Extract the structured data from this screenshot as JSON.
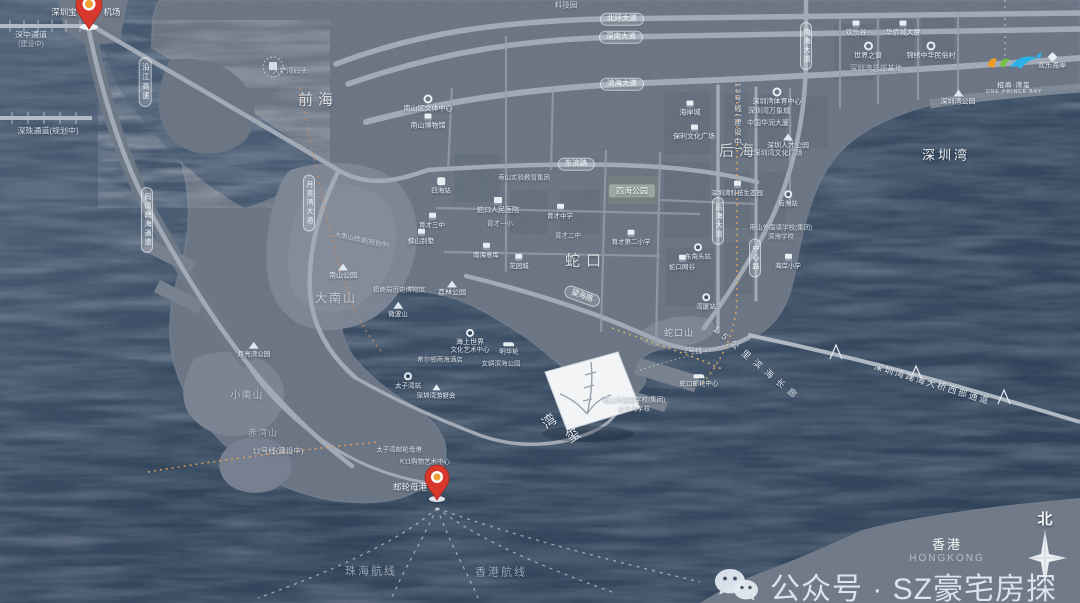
{
  "watermark": {
    "text": "公众号 · SZ豪宅房探"
  },
  "compass": {
    "north": "北"
  },
  "corner": {
    "hk": "香港",
    "hk_en": "HONGKONG"
  },
  "logo": {
    "line1": "招商·湾玺",
    "line2": "ONE PRINCE BAY"
  },
  "pins": [
    {
      "label_left": "深圳宝",
      "label_right": "机场"
    },
    {
      "label": "邮轮母港"
    }
  ],
  "colors": {
    "ocean": "#3a4d64",
    "land": "#6b7584",
    "hill": "#7e8795",
    "road": "#a0a8b4",
    "pin_red": "#d8382c",
    "metro_orange": "#dfa35b",
    "metro_yellow": "#d8c06a",
    "logo_orange": "#f59a23",
    "logo_green": "#7ac143",
    "logo_blue": "#2bb3e8"
  },
  "labels": [
    {
      "t": "前海",
      "k": "area",
      "x": 318,
      "y": 100,
      "fs": 15,
      "ls": 5,
      "o": 0.75
    },
    {
      "t": "后海",
      "k": "area",
      "x": 739,
      "y": 151,
      "fs": 15,
      "ls": 5,
      "o": 0.7
    },
    {
      "t": "蛇口",
      "k": "area",
      "x": 586,
      "y": 261,
      "fs": 15,
      "ls": 6,
      "o": 0.75
    },
    {
      "t": "深圳湾",
      "k": "area",
      "x": 946,
      "y": 156,
      "fs": 13,
      "ls": 3,
      "o": 0.9
    },
    {
      "t": "大南山",
      "k": "area",
      "x": 336,
      "y": 299,
      "fs": 12,
      "ls": 2,
      "o": 0.55
    },
    {
      "t": "小南山",
      "k": "area",
      "x": 247,
      "y": 396,
      "fs": 10,
      "ls": 1,
      "o": 0.5
    },
    {
      "t": "赤湾山",
      "k": "area",
      "x": 263,
      "y": 433,
      "fs": 9,
      "ls": 1,
      "o": 0.45
    },
    {
      "t": "蛇口山",
      "k": "area",
      "x": 679,
      "y": 333,
      "fs": 9,
      "ls": 1,
      "o": 0.65
    },
    {
      "t": "深中通道",
      "k": "text",
      "x": 31,
      "y": 35,
      "fs": 8,
      "o": 0.85
    },
    {
      "t": "(建设中)",
      "k": "text",
      "x": 31,
      "y": 45,
      "fs": 7,
      "o": 0.7
    },
    {
      "t": "深珠通道(规划中)",
      "k": "text",
      "x": 48,
      "y": 131,
      "fs": 8,
      "o": 0.85
    },
    {
      "t": "大铲湾码头",
      "k": "text",
      "x": 290,
      "y": 72,
      "fs": 7,
      "o": 0.75
    },
    {
      "t": "沿江高速",
      "k": "vpill",
      "x": 145,
      "y": 82,
      "fs": 7.5
    },
    {
      "t": "妈湾跨海通道",
      "k": "vpill",
      "x": 147,
      "y": 220,
      "fs": 7
    },
    {
      "t": "月亮湾大道",
      "k": "vpill",
      "x": 309,
      "y": 203,
      "fs": 7
    },
    {
      "t": "北环大道",
      "k": "pill",
      "x": 622,
      "y": 19,
      "fs": 7.5
    },
    {
      "t": "深南大道",
      "k": "pill",
      "x": 621,
      "y": 37,
      "fs": 7.5
    },
    {
      "t": "滨海大道",
      "k": "pill",
      "x": 622,
      "y": 84,
      "fs": 7.5
    },
    {
      "t": "东滨路",
      "k": "pill",
      "x": 576,
      "y": 164,
      "fs": 7.5
    },
    {
      "t": "望海路",
      "k": "pill",
      "x": 582,
      "y": 296,
      "fs": 7.5,
      "rot": 20
    },
    {
      "t": "南海大道",
      "k": "vpill",
      "x": 806,
      "y": 46,
      "fs": 7
    },
    {
      "t": "后海大道",
      "k": "vpill",
      "x": 718,
      "y": 221,
      "fs": 7
    },
    {
      "t": "中心路",
      "k": "vpill",
      "x": 755,
      "y": 258,
      "fs": 7
    },
    {
      "t": "13号线(建设中)",
      "k": "vtext",
      "x": 737,
      "y": 117,
      "fs": 7.5,
      "o": 0.9
    },
    {
      "t": "12号线(建设中)",
      "k": "text",
      "x": 278,
      "y": 452,
      "fs": 7.5,
      "o": 0.85
    },
    {
      "t": "2号线",
      "k": "text",
      "x": 693,
      "y": 352,
      "fs": 7,
      "o": 0.8
    },
    {
      "t": "深圳湾跨海大桥西部通道",
      "k": "text",
      "x": 932,
      "y": 384,
      "fs": 9,
      "rot": 17,
      "ls": 2,
      "o": 0.95,
      "n": "bridge-label"
    },
    {
      "t": "15公里滨海长廊",
      "k": "text",
      "x": 757,
      "y": 364,
      "fs": 9,
      "rot": 40,
      "ls": 6,
      "o": 0.9,
      "n": "promenade-label"
    },
    {
      "t": "珠海航线",
      "k": "route",
      "x": 371,
      "y": 572,
      "fs": 11,
      "ls": 2,
      "o": 0.65
    },
    {
      "t": "香港航线",
      "k": "route",
      "x": 501,
      "y": 573,
      "fs": 11,
      "ls": 2,
      "o": 0.65
    },
    {
      "t": "四海公园",
      "k": "park",
      "x": 632,
      "y": 191,
      "fs": 8
    },
    {
      "t": "科技园",
      "k": "text",
      "x": 566,
      "y": 6,
      "fs": 7.5,
      "o": 0.8
    },
    {
      "t": "欢乐谷",
      "k": "poi",
      "icon": "b",
      "x": 856,
      "y": 29,
      "fs": 7
    },
    {
      "t": "华侨城大厦",
      "k": "poi",
      "icon": "b",
      "x": 903,
      "y": 29,
      "fs": 7
    },
    {
      "t": "世界之窗",
      "k": "poi",
      "icon": "o",
      "x": 868,
      "y": 51,
      "fs": 7
    },
    {
      "t": "锦绣中华民俗村",
      "k": "poi",
      "icon": "o",
      "x": 931,
      "y": 51,
      "fs": 7
    },
    {
      "t": "深圳湾总部基地",
      "k": "text",
      "x": 876,
      "y": 69,
      "fs": 7.5,
      "o": 0.7
    },
    {
      "t": "深圳湾公园",
      "k": "poi",
      "icon": "m",
      "x": 958,
      "y": 98,
      "fs": 7
    },
    {
      "t": "欢乐海岸",
      "k": "poi",
      "icon": "d",
      "x": 1052,
      "y": 62,
      "fs": 7
    },
    {
      "t": "深圳湾体育中心",
      "k": "poi",
      "icon": "o",
      "x": 777,
      "y": 97,
      "fs": 7
    },
    {
      "t": "深圳湾万象城",
      "k": "text",
      "x": 769,
      "y": 112,
      "fs": 7,
      "o": 0.9
    },
    {
      "t": "中国华润大厦",
      "k": "text",
      "x": 768,
      "y": 124,
      "fs": 7,
      "o": 0.9
    },
    {
      "t": "深圳人才公园",
      "k": "poi",
      "icon": "m",
      "x": 788,
      "y": 142,
      "fs": 7
    },
    {
      "t": "深圳湾文化广场",
      "k": "text",
      "x": 778,
      "y": 154,
      "fs": 7,
      "o": 0.9
    },
    {
      "t": "海岸城",
      "k": "poi",
      "icon": "b",
      "x": 690,
      "y": 109,
      "fs": 7
    },
    {
      "t": "保利文化广场",
      "k": "poi",
      "icon": "b",
      "x": 694,
      "y": 133,
      "fs": 7
    },
    {
      "t": "深圳湾科技生态园",
      "k": "poi",
      "icon": "b",
      "x": 737,
      "y": 189,
      "fs": 6.5
    },
    {
      "t": "后海站",
      "k": "poi",
      "icon": "st",
      "x": 788,
      "y": 199,
      "fs": 6.5
    },
    {
      "t": "南山外国语学校(集团)",
      "k": "text",
      "x": 781,
      "y": 228,
      "fs": 6.5,
      "o": 0.85
    },
    {
      "t": "滨海学校",
      "k": "text",
      "x": 781,
      "y": 237,
      "fs": 6.5,
      "o": 0.85
    },
    {
      "t": "海岸小学",
      "k": "poi",
      "icon": "b",
      "x": 788,
      "y": 262,
      "fs": 6.5
    },
    {
      "t": "蛇口网谷",
      "k": "poi",
      "icon": "b",
      "x": 682,
      "y": 263,
      "fs": 6.5
    },
    {
      "t": "东角头站",
      "k": "poi",
      "icon": "st",
      "x": 698,
      "y": 252,
      "fs": 6.5
    },
    {
      "t": "湾厦站",
      "k": "poi",
      "icon": "st",
      "x": 706,
      "y": 302,
      "fs": 6.5
    },
    {
      "t": "南山区文体中心",
      "k": "poi",
      "icon": "o",
      "x": 428,
      "y": 104,
      "fs": 7
    },
    {
      "t": "南山博物馆",
      "k": "poi",
      "icon": "b",
      "x": 428,
      "y": 122,
      "fs": 7
    },
    {
      "t": "四海站",
      "k": "poi",
      "icon": "M",
      "x": 441,
      "y": 186,
      "fs": 6.5
    },
    {
      "t": "南山实验教育集团",
      "k": "text",
      "x": 524,
      "y": 178,
      "fs": 6.5,
      "o": 0.85
    },
    {
      "t": "蛇口人民医院",
      "k": "poi",
      "icon": "h",
      "x": 498,
      "y": 206,
      "fs": 7
    },
    {
      "t": "育才中学",
      "k": "poi",
      "icon": "b",
      "x": 560,
      "y": 212,
      "fs": 6.5
    },
    {
      "t": "育才一小",
      "k": "text",
      "x": 500,
      "y": 224,
      "fs": 6.5,
      "o": 0.85
    },
    {
      "t": "育才二中",
      "k": "text",
      "x": 568,
      "y": 236,
      "fs": 6.5,
      "o": 0.85
    },
    {
      "t": "育才第二小学",
      "k": "poi",
      "icon": "b",
      "x": 631,
      "y": 238,
      "fs": 6.5
    },
    {
      "t": "南海意库",
      "k": "poi",
      "icon": "b",
      "x": 486,
      "y": 251,
      "fs": 6.5
    },
    {
      "t": "花园城",
      "k": "poi",
      "icon": "b",
      "x": 519,
      "y": 262,
      "fs": 6.5
    },
    {
      "t": "育才三中",
      "k": "poi",
      "icon": "b",
      "x": 432,
      "y": 221,
      "fs": 6.5
    },
    {
      "t": "鲸山别墅",
      "k": "poi",
      "icon": "b",
      "x": 421,
      "y": 237,
      "fs": 6.5
    },
    {
      "t": "大南山栈道(规划中)",
      "k": "text",
      "x": 362,
      "y": 241,
      "fs": 6.5,
      "rot": 12,
      "o": 0.7
    },
    {
      "t": "南山公园",
      "k": "poi",
      "icon": "m",
      "x": 343,
      "y": 272,
      "fs": 7
    },
    {
      "t": "荔林公园",
      "k": "poi",
      "icon": "m",
      "x": 452,
      "y": 289,
      "fs": 7
    },
    {
      "t": "微波山",
      "k": "poi",
      "icon": "m",
      "x": 398,
      "y": 310,
      "fs": 6.5
    },
    {
      "t": "月亮湾公园",
      "k": "poi",
      "icon": "m",
      "x": 254,
      "y": 350,
      "fs": 6.5
    },
    {
      "t": "招商局历史博物馆",
      "k": "text",
      "x": 399,
      "y": 290,
      "fs": 6.5,
      "o": 0.85
    },
    {
      "t": "海上世界",
      "k": "poi",
      "icon": "st",
      "x": 470,
      "y": 338,
      "fs": 7
    },
    {
      "t": "文化艺术中心",
      "k": "text",
      "x": 470,
      "y": 350,
      "fs": 6.5,
      "o": 0.9
    },
    {
      "t": "明华轮",
      "k": "poi",
      "icon": "ship",
      "x": 509,
      "y": 349,
      "fs": 6.5
    },
    {
      "t": "女娲滨海公园",
      "k": "text",
      "x": 501,
      "y": 364,
      "fs": 6.5,
      "o": 0.85
    },
    {
      "t": "希尔顿南海酒店",
      "k": "text",
      "x": 440,
      "y": 360,
      "fs": 6.5,
      "o": 0.85
    },
    {
      "t": "深圳湾游艇会",
      "k": "poi",
      "icon": "boat",
      "x": 436,
      "y": 392,
      "fs": 6.5
    },
    {
      "t": "太子湾站",
      "k": "poi",
      "icon": "st",
      "x": 408,
      "y": 381,
      "fs": 6.5
    },
    {
      "t": "蛇口邮轮中心",
      "k": "poi",
      "icon": "ship",
      "x": 699,
      "y": 381,
      "fs": 6.5
    },
    {
      "t": "南山外国语学校(集团)",
      "k": "text",
      "x": 634,
      "y": 400,
      "fs": 6.5,
      "o": 0.9
    },
    {
      "t": "太子湾学校",
      "k": "text",
      "x": 634,
      "y": 409,
      "fs": 6.5,
      "o": 0.9
    },
    {
      "t": "太子湾邮轮母港",
      "k": "text",
      "x": 399,
      "y": 450,
      "fs": 6.5,
      "o": 0.9
    },
    {
      "t": "K11购物艺术中心",
      "k": "text",
      "x": 425,
      "y": 462,
      "fs": 6.5,
      "o": 0.9
    },
    {
      "t": "湾",
      "k": "text",
      "x": 549,
      "y": 421,
      "fs": 14,
      "rot": -35,
      "o": 0.95,
      "n": "project-name-char"
    },
    {
      "t": "玺",
      "k": "text",
      "x": 573,
      "y": 435,
      "fs": 14,
      "rot": -35,
      "o": 0.95,
      "n": "project-name-char"
    }
  ]
}
